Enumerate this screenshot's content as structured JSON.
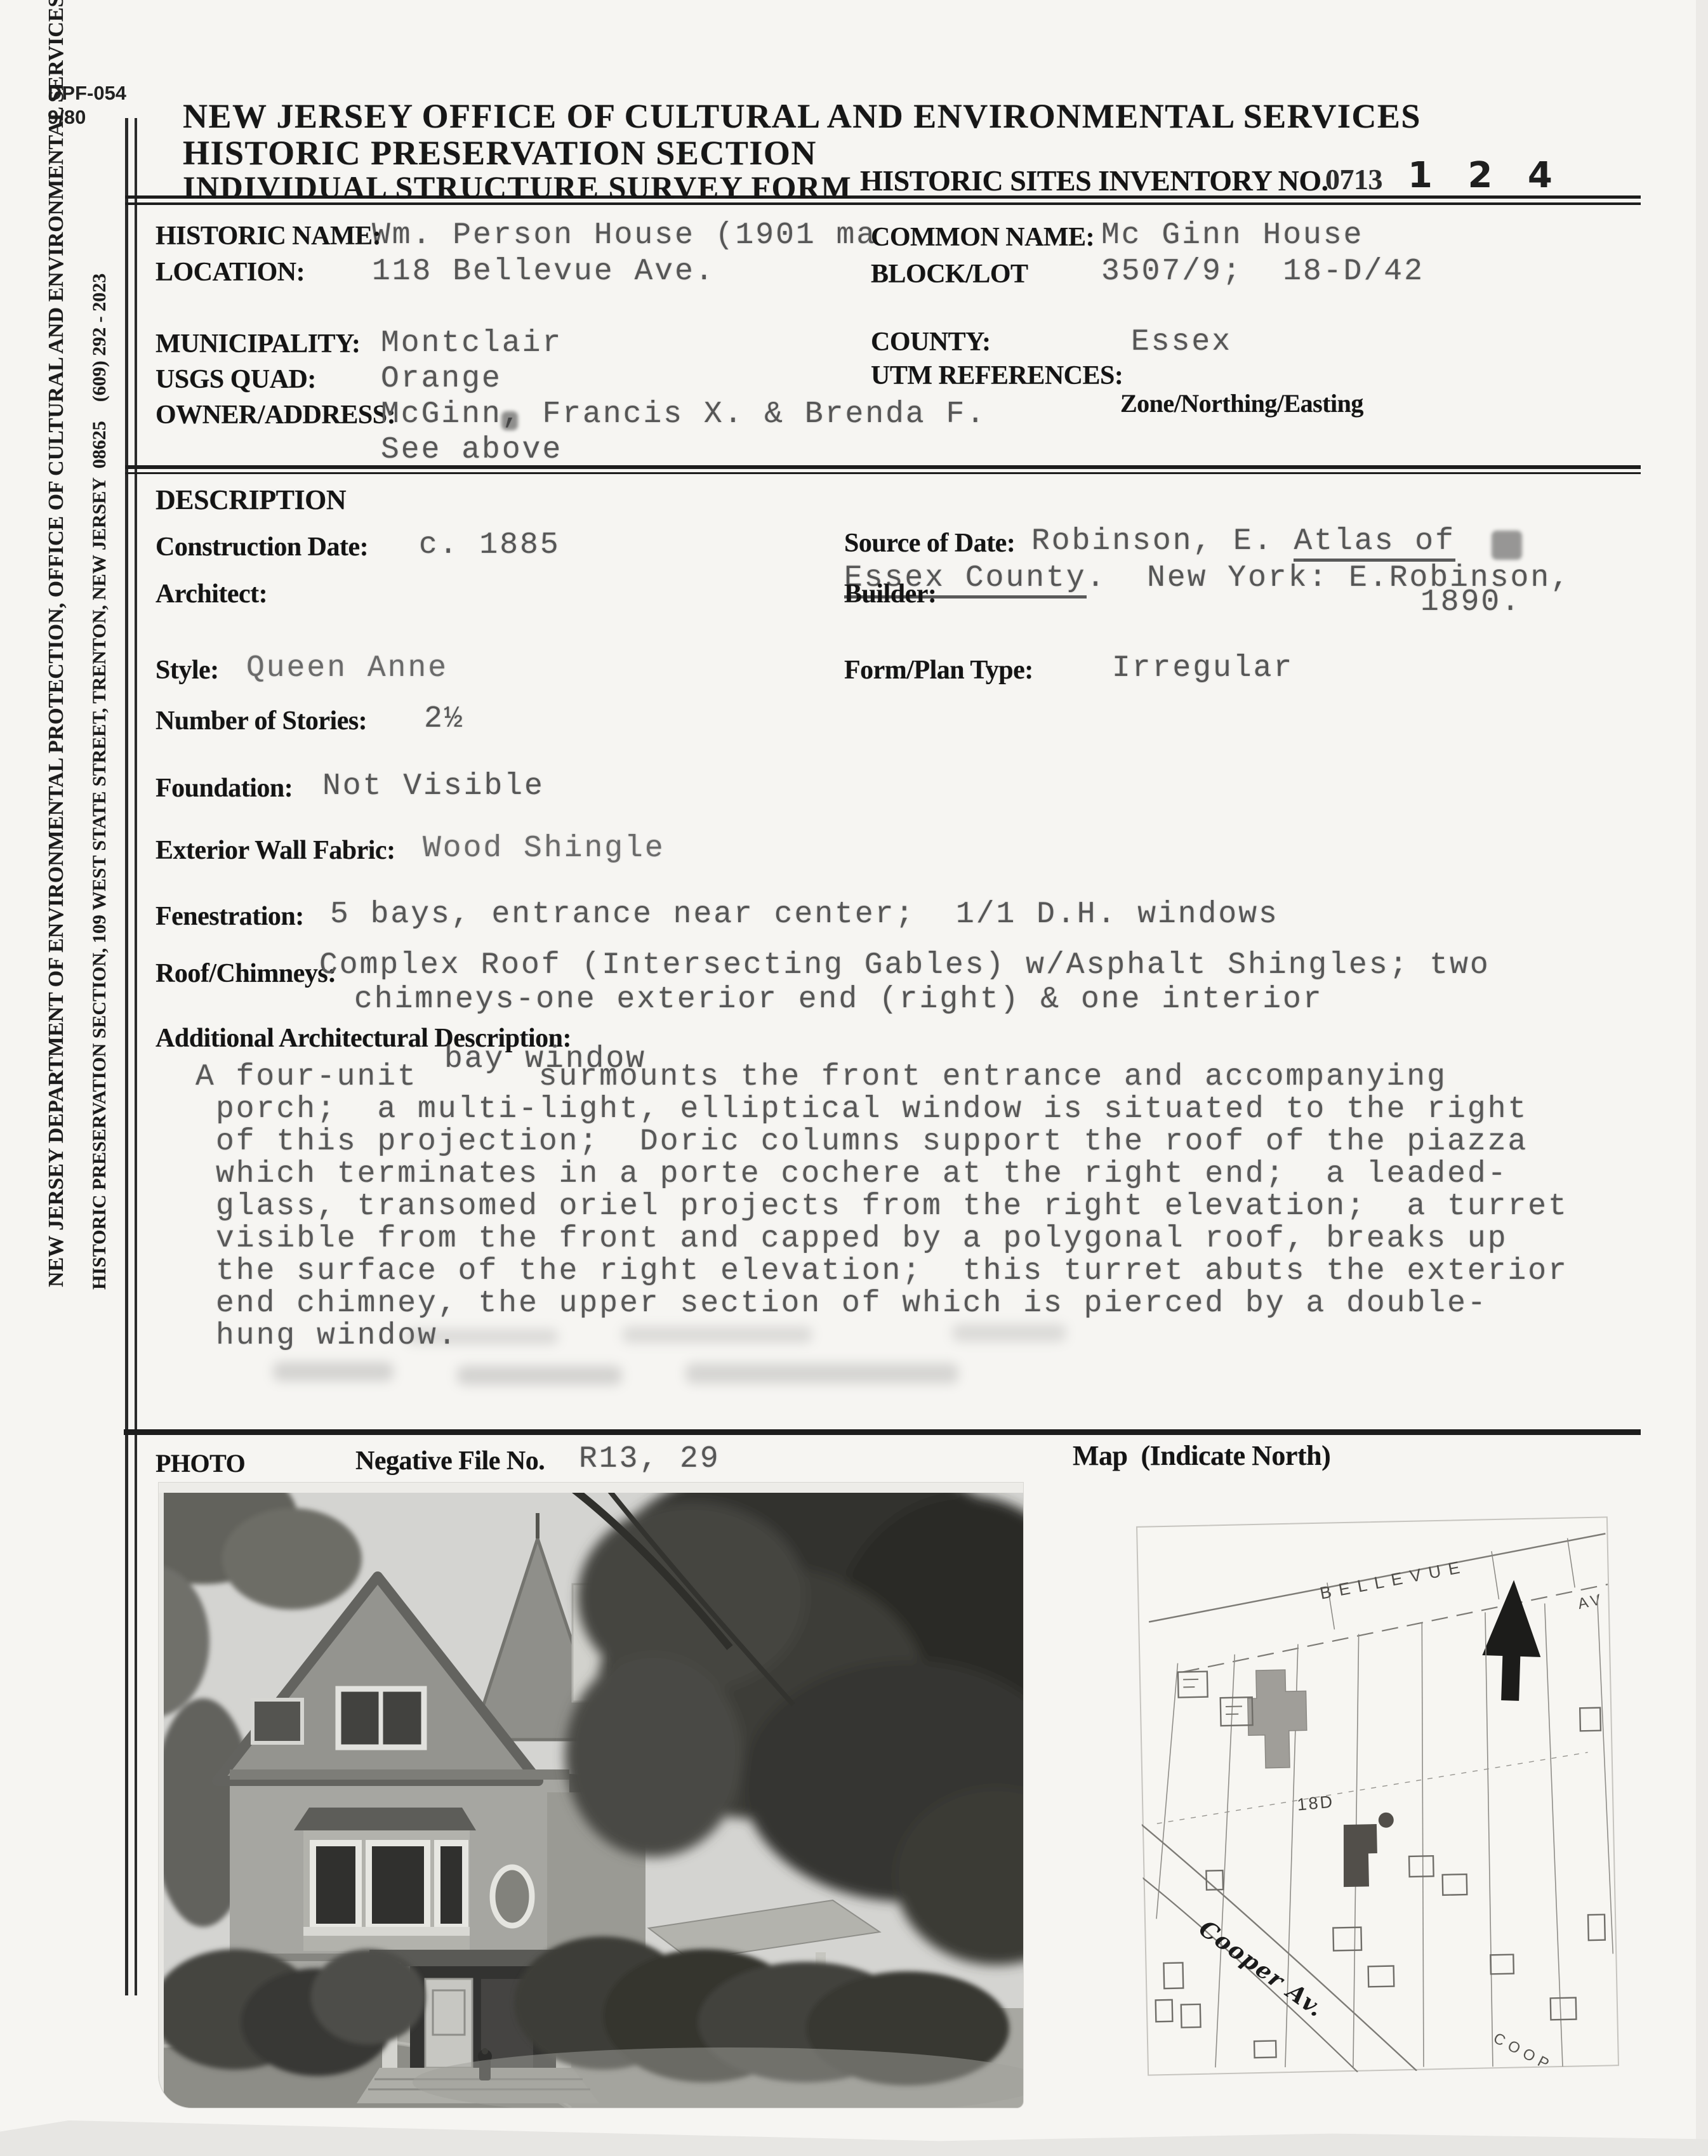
{
  "form_meta": {
    "number": "DPF-054",
    "revision": "9/80"
  },
  "header": {
    "office": "NEW JERSEY OFFICE OF CULTURAL AND ENVIRONMENTAL SERVICES",
    "section": "HISTORIC PRESERVATION SECTION",
    "form_title": "INDIVIDUAL STRUCTURE SURVEY FORM",
    "inventory_label": "HISTORIC SITES INVENTORY NO.",
    "inventory_prefix": "0713",
    "inventory_stamp": "1 2 4"
  },
  "sidebar": {
    "line1": "NEW JERSEY DEPARTMENT OF ENVIRONMENTAL PROTECTION, OFFICE OF CULTURAL AND ENVIRONMENTAL SERVICES",
    "line2": "HISTORIC PRESERVATION SECTION, 109 WEST STATE STREET, TRENTON, NEW JERSEY  08625    (609) 292 - 2023"
  },
  "identification": {
    "historic_name_label": "HISTORIC NAME:",
    "historic_name": "Wm. Person House (1901 ma",
    "common_name_label": "COMMON NAME:",
    "common_name": "Mc Ginn House",
    "location_label": "LOCATION:",
    "location": "118 Bellevue Ave.",
    "block_lot_label": "BLOCK/LOT",
    "block_lot": "3507/9;  18-D/42",
    "municipality_label": "MUNICIPALITY:",
    "municipality": "Montclair",
    "county_label": "COUNTY:",
    "county": "Essex",
    "usgs_quad_label": "USGS QUAD:",
    "usgs_quad": "Orange",
    "utm_label": "UTM REFERENCES:",
    "utm_sublabel": "Zone/Northing/Easting",
    "owner_label": "OWNER/ADDRESS:",
    "owner": "McGinn, Francis X. & Brenda F.",
    "owner_line2": "See above"
  },
  "description": {
    "heading": "DESCRIPTION",
    "construction_date_label": "Construction Date:",
    "construction_date": "c. 1885",
    "source_label": "Source of Date:",
    "source_part1": "Robinson, E. ",
    "source_part2_underlined": "Atlas of",
    "source_line2_underlined": "Essex County",
    "source_line2_rest": ".  New York: E.Robinson,",
    "source_line3": "1890.",
    "architect_label": "Architect:",
    "builder_label": "Builder:",
    "style_label": "Style:",
    "style": "Queen Anne",
    "form_plan_label": "Form/Plan Type:",
    "form_plan": "Irregular",
    "stories_label": "Number of Stories:",
    "stories": "2½",
    "foundation_label": "Foundation:",
    "foundation": "Not Visible",
    "wall_fabric_label": "Exterior Wall Fabric:",
    "wall_fabric": "Wood Shingle",
    "fenestration_label": "Fenestration:",
    "fenestration": "5 bays, entrance near center;  1/1 D.H. windows",
    "roof_label": "Roof/Chimneys:",
    "roof_line1": "Complex Roof (Intersecting Gables) w/Asphalt Shingles; two",
    "roof_line2": "chimneys-one exterior end (right) & one interior",
    "additional_label": "Additional Architectural Description:",
    "additional_insert": "bay window",
    "additional_lines": [
      "A four-unit      surmounts the front entrance and accompanying",
      "porch;  a multi-light, elliptical window is situated to the right",
      "of this projection;  Doric columns support the roof of the piazza",
      "which terminates in a porte cochere at the right end;  a leaded-",
      "glass, transomed oriel projects from the right elevation;  a turret",
      "visible from the front and capped by a polygonal roof, breaks up",
      "the surface of the right elevation;  this turret abuts the exterior",
      "end chimney, the upper section of which is pierced by a double-",
      "hung window."
    ]
  },
  "photo_section": {
    "photo_label": "PHOTO",
    "negative_label": "Negative File No.",
    "negative_value": "R13, 29",
    "map_label": "Map  (Indicate North)"
  },
  "map": {
    "street_top": "BELLEVUE",
    "street_top_abbr": "AV",
    "block_label": "18D",
    "street_bottom_hand": "Cooper Av.",
    "street_bottom_print": "COOP",
    "north_arrow_icon": "north-arrow"
  }
}
